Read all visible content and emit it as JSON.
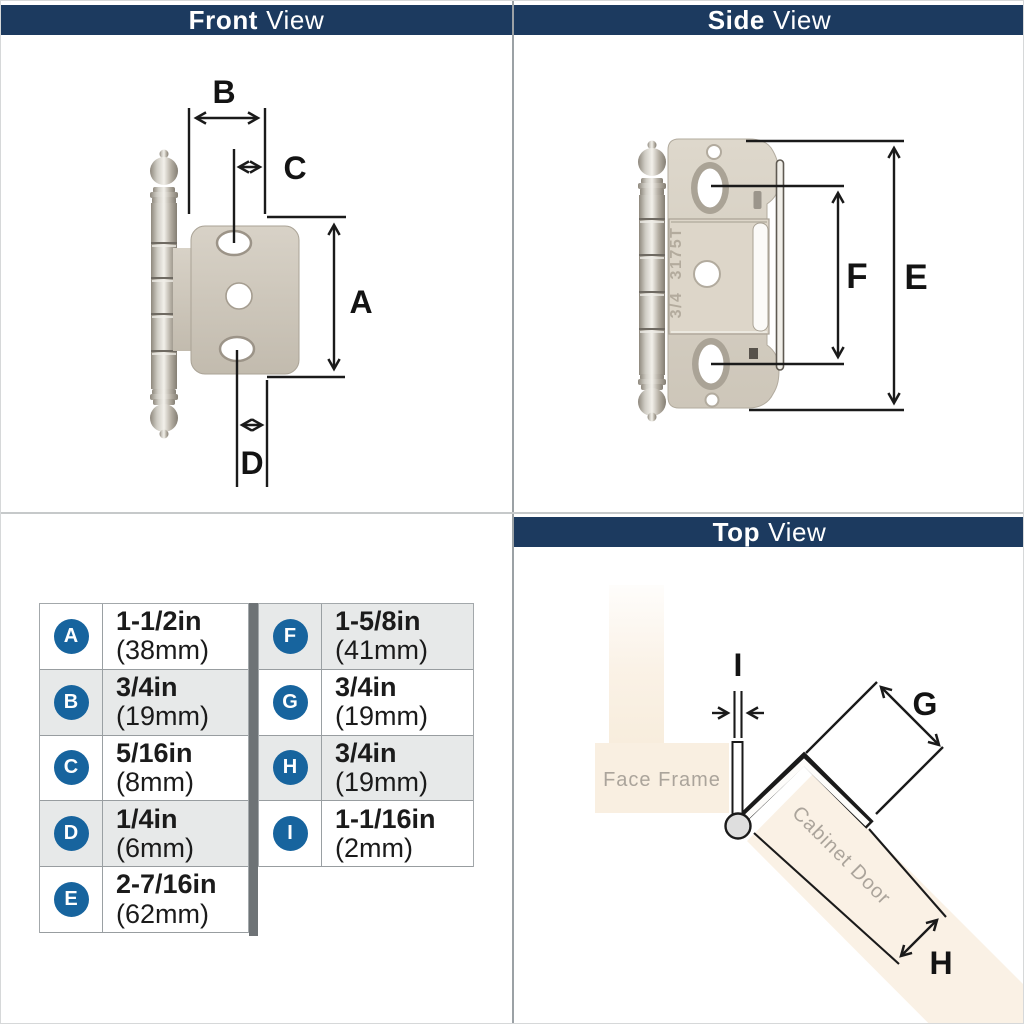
{
  "colors": {
    "navy": "#1c3a5f",
    "badge-blue": "#17649e",
    "row-alt": "#e7e9e9",
    "table-bar": "#6e7376",
    "cream": "#f9efe1",
    "soft-text": "#aba49b",
    "metal-light": "#d8d2c7",
    "metal-dark": "#c2bbae",
    "line-black": "#1a1a1a"
  },
  "headers": {
    "front": {
      "bold": "Front",
      "regular": "View"
    },
    "side": {
      "bold": "Side",
      "regular": "View"
    },
    "top": {
      "bold": "Top",
      "regular": "View"
    }
  },
  "front_view": {
    "labels": {
      "a": "A",
      "b": "B",
      "c": "C",
      "d": "D"
    }
  },
  "side_view": {
    "labels": {
      "e": "E",
      "f": "F"
    },
    "stamp_line1": "3175T",
    "stamp_line2": "3/4"
  },
  "top_view": {
    "labels": {
      "g": "G",
      "h": "H",
      "i": "I"
    },
    "face_frame_label": "Face Frame",
    "cabinet_door_label": "Cabinet Door"
  },
  "dimension_table": {
    "left": [
      {
        "letter": "A",
        "value": "1-1/2in",
        "metric": "(38mm)"
      },
      {
        "letter": "B",
        "value": "3/4in",
        "metric": "(19mm)"
      },
      {
        "letter": "C",
        "value": "5/16in",
        "metric": "(8mm)"
      },
      {
        "letter": "D",
        "value": "1/4in",
        "metric": "(6mm)"
      },
      {
        "letter": "E",
        "value": "2-7/16in",
        "metric": "(62mm)"
      }
    ],
    "right": [
      {
        "letter": "F",
        "value": "1-5/8in",
        "metric": "(41mm)"
      },
      {
        "letter": "G",
        "value": "3/4in",
        "metric": "(19mm)"
      },
      {
        "letter": "H",
        "value": "3/4in",
        "metric": "(19mm)"
      },
      {
        "letter": "I",
        "value": "1-1/16in",
        "metric": "(2mm)"
      }
    ]
  }
}
